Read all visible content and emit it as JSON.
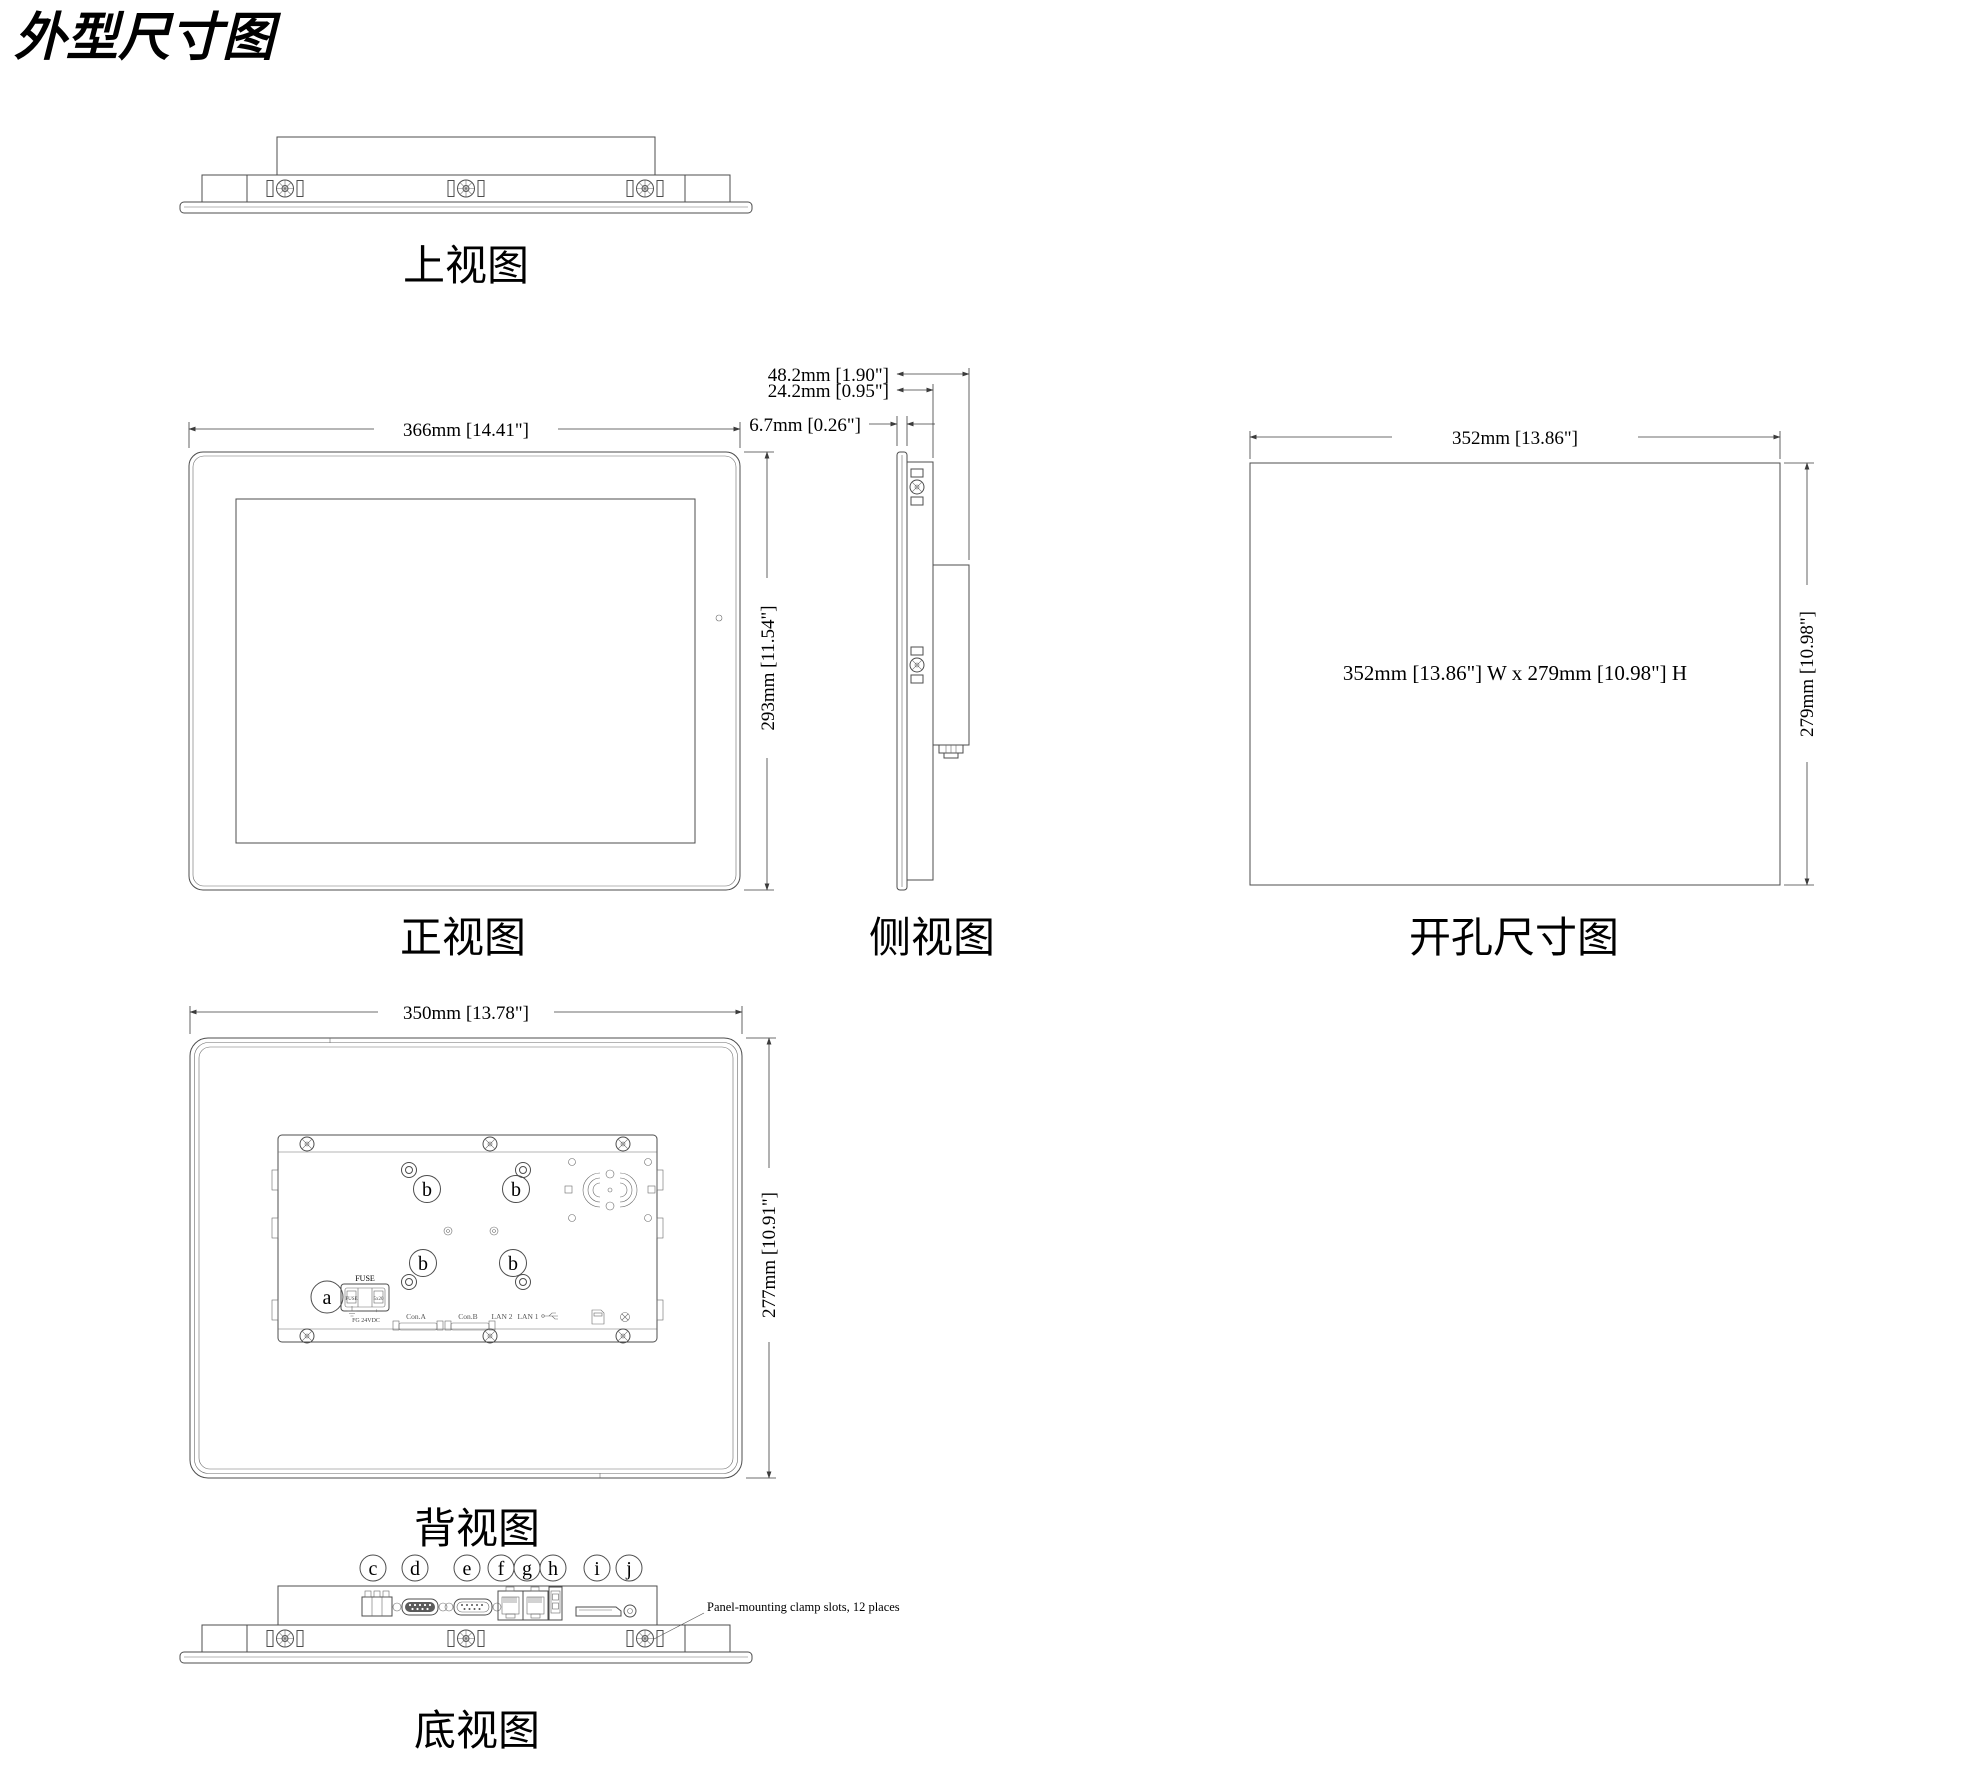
{
  "title": "外型尺寸图",
  "views": {
    "top": {
      "label": "上视图"
    },
    "front": {
      "label": "正视图",
      "width": "366mm [14.41\"]",
      "height": "293mm [11.54\"]"
    },
    "side": {
      "label": "侧视图",
      "depth_total": "48.2mm [1.90\"]",
      "depth_mid": "24.2mm [0.95\"]",
      "bezel": "6.7mm [0.26\"]"
    },
    "cutout": {
      "label": "开孔尺寸图",
      "width": "352mm [13.86\"]",
      "height": "279mm [10.98\"]",
      "note": "352mm [13.86\"] W x 279mm [10.98\"] H"
    },
    "rear": {
      "label": "背视图",
      "width": "350mm [13.78\"]",
      "height": "277mm [10.91\"]",
      "callout_a": "a",
      "callout_b": "b",
      "fuse": "FUSE",
      "fuse_inner": "FUSE",
      "fuse_size": "5x20",
      "polarity": "+ −",
      "power": "FG  24VDC",
      "ports": [
        "Con.A",
        "Con.B",
        "LAN 2",
        "LAN 1"
      ]
    },
    "bottom": {
      "label": "底视图",
      "callouts": [
        "c",
        "d",
        "e",
        "f",
        "g",
        "h",
        "i",
        "j"
      ],
      "note": "Panel-mounting clamp slots, 12 places"
    }
  }
}
